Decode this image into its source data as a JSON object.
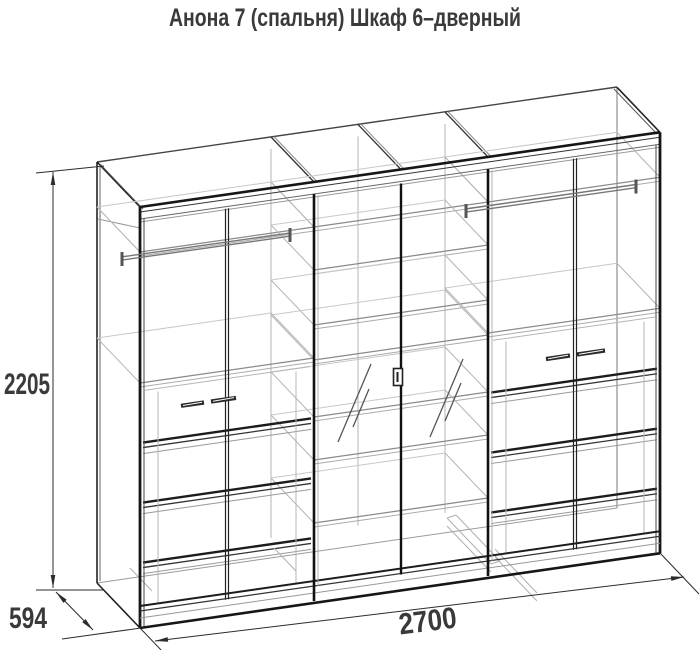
{
  "title": "Анона 7 (спальня) Шкаф 6–дверный",
  "dimensions": {
    "height": "2205",
    "depth": "594",
    "width": "2700"
  },
  "diagram": {
    "type": "furniture-technical-drawing",
    "view": "three-quarter wireframe projection",
    "item": "Шкаф 6-дверный",
    "series": "Анона 7 (спальня)",
    "doors": 6,
    "mirror_doors": 2,
    "hanging_rods": 2,
    "drawer_rows_per_outer_section": 3
  },
  "colors": {
    "background": "#ffffff",
    "line_dark": "#161616",
    "line_mid": "#555555",
    "line_light": "#b5b5b5",
    "line_faint": "#c8c8c8",
    "dimension": "#2b2b2b",
    "text": "#3a3a3a"
  }
}
